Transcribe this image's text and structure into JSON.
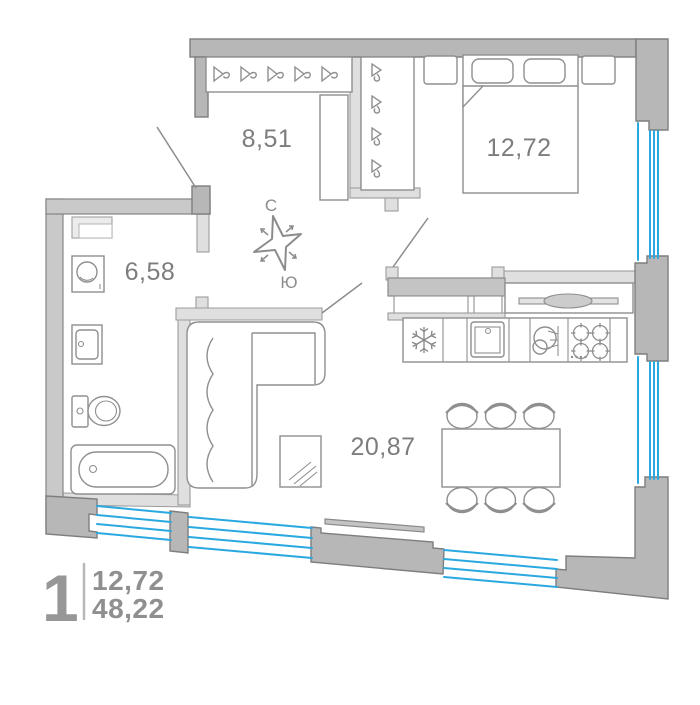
{
  "plan": {
    "title": "apartment-floor-plan",
    "compass": {
      "north": "С",
      "south": "Ю"
    },
    "rooms": {
      "hallway": {
        "area": "8,51"
      },
      "bedroom": {
        "area": "12,72"
      },
      "bathroom": {
        "area": "6,58"
      },
      "living_kitchen": {
        "area": "20,87"
      }
    },
    "legend": {
      "rooms_count": "1",
      "living_area": "12,72",
      "total_area": "48,22"
    },
    "colors": {
      "wall": "#b7b7b7",
      "partition": "#dfdfdf",
      "outline": "#7e7e7e",
      "window_glazing": "#2aa9e0",
      "label_text": "#7d7d7d",
      "legend_text": "#8f8f8f"
    }
  }
}
